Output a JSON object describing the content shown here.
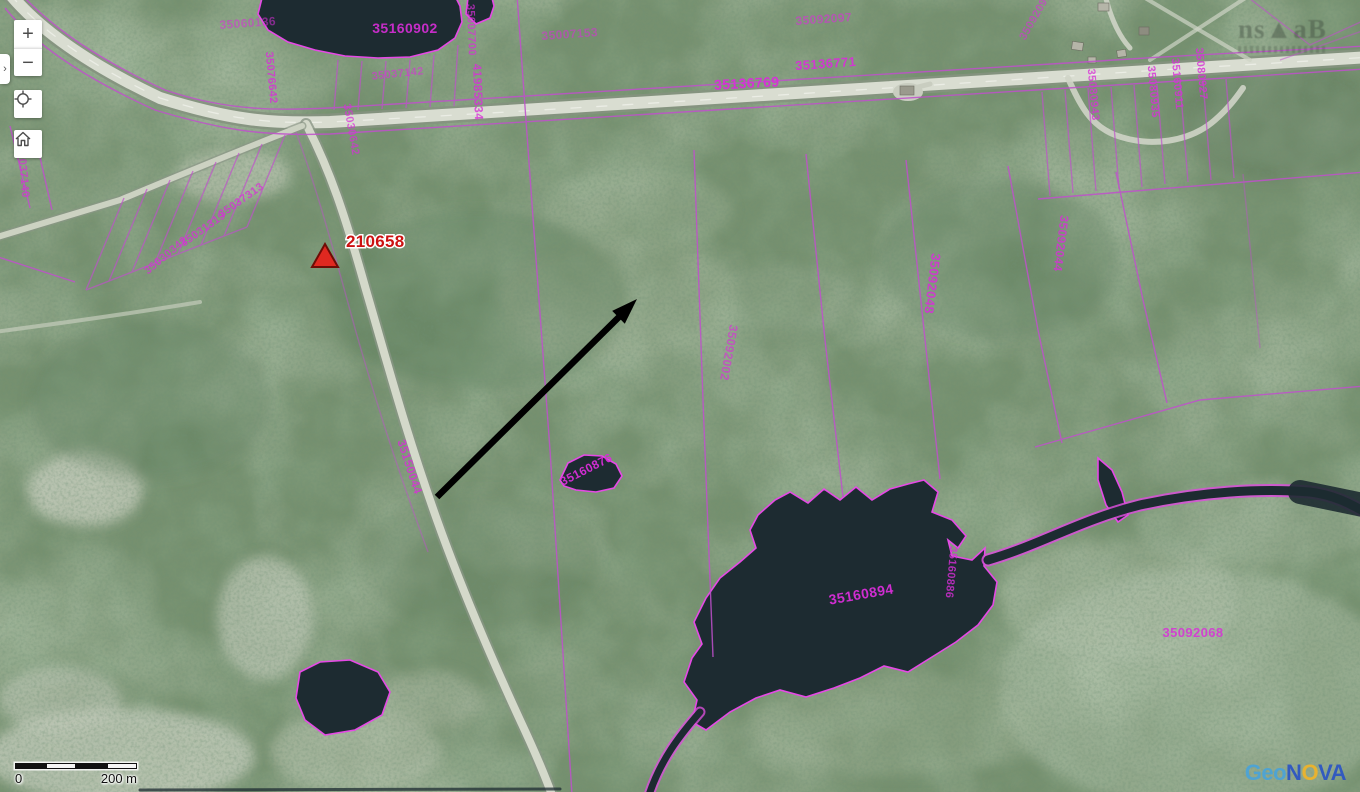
{
  "controls": {
    "expand_tab": "›",
    "zoom_in": "+",
    "zoom_out": "−",
    "locate_icon": "crosshair-icon",
    "home_icon": "home-icon"
  },
  "scalebar": {
    "start": "0",
    "end": "200 m"
  },
  "logo": {
    "geo": "Geo",
    "n": "N",
    "o": "O",
    "va": "VA",
    "geo_color": "#4aa3d8",
    "nova_color": "#2b54c4",
    "o_color": "#f0b429"
  },
  "watermark": {
    "text": "ns▲aB"
  },
  "marker": {
    "label": "210658",
    "color": "#cc1111"
  },
  "map_colors": {
    "parcel_line": "#c050cc",
    "parcel_label": "#d92ed9",
    "water_fill": "#1d2b31",
    "water_outline": "#e649e6",
    "road_fill": "#d9ddd1"
  },
  "map": {
    "labels": [
      {
        "t": "35160902",
        "x": 405,
        "y": 33,
        "rot": 0,
        "fs": 14,
        "op": 0.9
      },
      {
        "t": "35136769",
        "x": 747,
        "y": 88,
        "rot": -3,
        "fs": 14,
        "op": 0.95
      },
      {
        "t": "35136771",
        "x": 826,
        "y": 68,
        "rot": -4,
        "fs": 13,
        "op": 0.9
      },
      {
        "t": "35092097",
        "x": 824,
        "y": 23,
        "rot": -4,
        "fs": 12,
        "op": 0.6
      },
      {
        "t": "35007153",
        "x": 570,
        "y": 38,
        "rot": -4,
        "fs": 12,
        "op": 0.55
      },
      {
        "t": "35037142",
        "x": 398,
        "y": 77,
        "rot": -6,
        "fs": 11,
        "op": 0.6
      },
      {
        "t": "35060136",
        "x": 248,
        "y": 27,
        "rot": -4,
        "fs": 12,
        "op": 0.55
      },
      {
        "t": "35092068",
        "x": 1193,
        "y": 637,
        "rot": 0,
        "fs": 13,
        "op": 0.85
      },
      {
        "t": "35160894",
        "x": 862,
        "y": 599,
        "rot": -10,
        "fs": 14,
        "op": 0.95
      },
      {
        "t": "35160876",
        "x": 588,
        "y": 473,
        "rot": -27,
        "fs": 12,
        "op": 0.95
      },
      {
        "t": "35092048",
        "x": 928,
        "y": 283,
        "rot": 97,
        "fs": 13,
        "op": 0.85
      },
      {
        "t": "35092044",
        "x": 1057,
        "y": 243,
        "rot": 97,
        "fs": 12,
        "op": 0.8
      },
      {
        "t": "35092002",
        "x": 725,
        "y": 352,
        "rot": 100,
        "fs": 12,
        "op": 0.65
      },
      {
        "t": "35150044",
        "x": 406,
        "y": 468,
        "rot": 72,
        "fs": 12,
        "op": 0.8
      },
      {
        "t": "41985334",
        "x": 474,
        "y": 92,
        "rot": 88,
        "fs": 12,
        "op": 0.8
      },
      {
        "t": "35007700",
        "x": 468,
        "y": 30,
        "rot": 88,
        "fs": 11,
        "op": 0.7
      },
      {
        "t": "35080935",
        "x": 1150,
        "y": 92,
        "rot": 85,
        "fs": 11,
        "op": 0.8
      },
      {
        "t": "35160911",
        "x": 1174,
        "y": 84,
        "rot": 85,
        "fs": 11,
        "op": 0.8
      },
      {
        "t": "35080927",
        "x": 1198,
        "y": 74,
        "rot": 85,
        "fs": 11,
        "op": 0.8
      },
      {
        "t": "35080943",
        "x": 1090,
        "y": 95,
        "rot": 85,
        "fs": 11,
        "op": 0.75
      },
      {
        "t": "35092091",
        "x": 1038,
        "y": 18,
        "rot": -60,
        "fs": 11,
        "op": 0.6
      },
      {
        "t": "35076642",
        "x": 268,
        "y": 78,
        "rot": 85,
        "fs": 11,
        "op": 0.8
      },
      {
        "t": "35030642",
        "x": 348,
        "y": 130,
        "rot": 80,
        "fs": 11,
        "op": 0.7
      },
      {
        "t": "35037313",
        "x": 243,
        "y": 203,
        "rot": -35,
        "fs": 11,
        "op": 0.75
      },
      {
        "t": "35031319",
        "x": 205,
        "y": 232,
        "rot": -35,
        "fs": 11,
        "op": 0.75
      },
      {
        "t": "35030342",
        "x": 168,
        "y": 258,
        "rot": -40,
        "fs": 11,
        "op": 0.7
      },
      {
        "t": "35037140",
        "x": 20,
        "y": 172,
        "rot": 85,
        "fs": 11,
        "op": 0.7
      },
      {
        "t": "35160886",
        "x": 948,
        "y": 572,
        "rot": 95,
        "fs": 11,
        "op": 0.8
      }
    ]
  }
}
